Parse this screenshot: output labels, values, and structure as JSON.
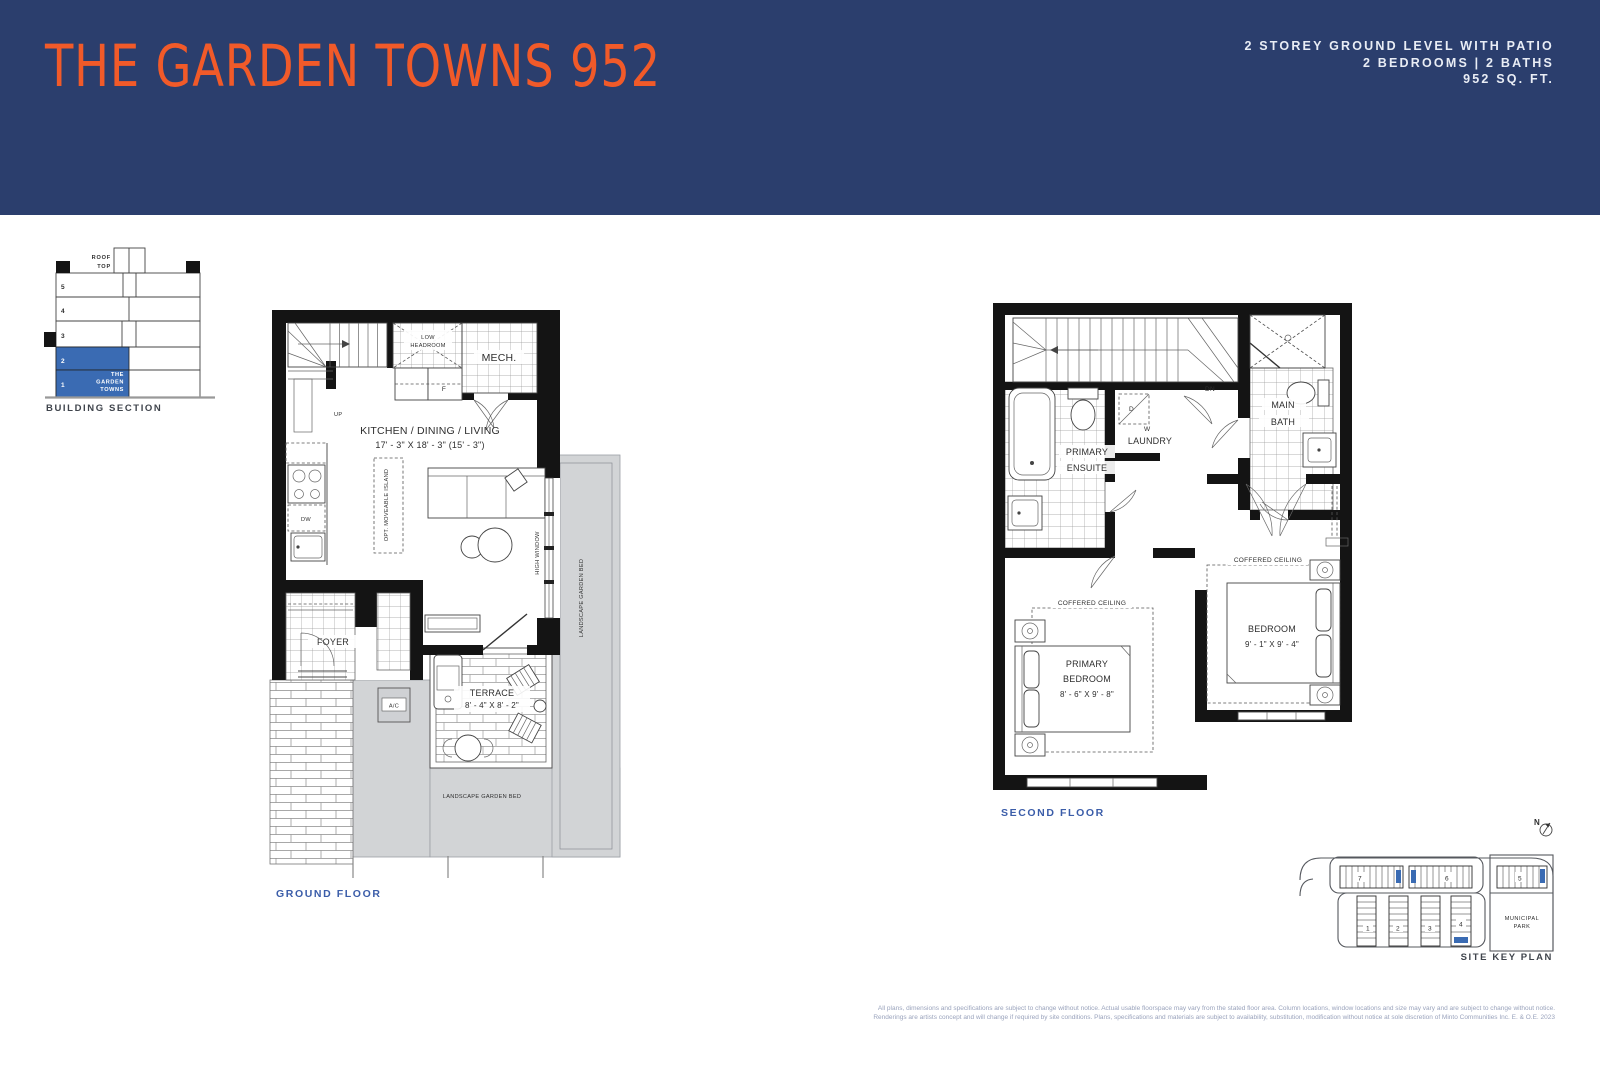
{
  "header": {
    "title": "THE GARDEN TOWNS 952",
    "spec_line1": "2 STOREY GROUND LEVEL WITH PATIO",
    "spec_line2": "2 BEDROOMS  |  2 BATHS",
    "spec_line3": "952 SQ. FT.",
    "bg_color": "#2B3E6D",
    "title_color": "#F15A29"
  },
  "building_section": {
    "label": "BUILDING SECTION",
    "roof_line1": "ROOF",
    "roof_line2": "TOP",
    "floors": [
      "5",
      "4",
      "3",
      "2",
      "1"
    ],
    "highlight_line1": "THE",
    "highlight_line2": "GARDEN",
    "highlight_line3": "TOWNS",
    "highlight_color": "#3A6BB3"
  },
  "ground_floor": {
    "label": "GROUND FLOOR",
    "rooms": {
      "kitchen_title": "KITCHEN / DINING / LIVING",
      "kitchen_dims": "17' - 3\" X 18' - 3\" (15' - 3\")",
      "mech": "MECH.",
      "low_headroom_1": "LOW",
      "low_headroom_2": "HEADROOM",
      "fridge": "F",
      "dishwasher": "DW",
      "up": "UP",
      "foyer": "FOYER",
      "ac_unit": "A/C",
      "island": "OPT. MOVEABLE ISLAND",
      "terrace_title": "TERRACE",
      "terrace_dims": "8' - 4\" X 8' - 2\"",
      "high_window": "HIGH WINDOW",
      "garden_bed": "LANDSCAPE GARDEN BED"
    }
  },
  "second_floor": {
    "label": "SECOND FLOOR",
    "rooms": {
      "dn": "DN",
      "primary_ensuite_1": "PRIMARY",
      "primary_ensuite_2": "ENSUITE",
      "laundry": "LAUNDRY",
      "washer": "W",
      "dryer": "D",
      "main_bath_1": "MAIN",
      "main_bath_2": "BATH",
      "coffered": "COFFERED CEILING",
      "primary_bedroom_1": "PRIMARY",
      "primary_bedroom_2": "BEDROOM",
      "primary_bedroom_dims": "8' - 6\" X 9' - 8\"",
      "bedroom": "BEDROOM",
      "bedroom_dims": "9' - 1\" X 9' - 4\""
    }
  },
  "site_key_plan": {
    "label": "SITE KEY PLAN",
    "north": "N",
    "park_line1": "MUNICIPAL",
    "park_line2": "PARK",
    "buildings": [
      "1",
      "2",
      "3",
      "4",
      "5",
      "6",
      "7"
    ],
    "highlight_color": "#3A6BB3"
  },
  "disclaimer": {
    "line1": "All plans, dimensions and specifications are subject to change without notice. Actual usable floorspace may vary from the stated floor area. Column locations, window locations and size may vary and are subject to change without notice.",
    "line2": "Renderings are artists concept and will change if required by site conditions. Plans, specifications and materials are subject to availability, substitution, modification without notice at sole discretion of Minto Communities Inc. E. & O.E. 2023"
  }
}
